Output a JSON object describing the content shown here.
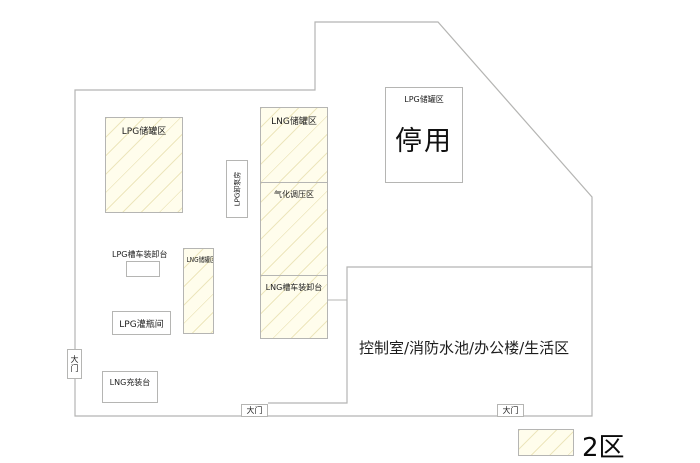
{
  "title": "LPG/LNG 站区平面图",
  "areas": {
    "lpg_storage_left": {
      "label": "LPG储罐区"
    },
    "lpg_pump_room": {
      "label": "LPG卸泵房"
    },
    "lng_storage": {
      "label": "LNG储罐区"
    },
    "gasification": {
      "label": "气化调压区"
    },
    "lng_truck_platform": {
      "label": "LNG槽车装卸台"
    },
    "lpg_storage_disabled": {
      "label": "LPG储罐区",
      "status": "停用"
    },
    "lpg_truck_platform": {
      "label": "LPG槽车装卸台"
    },
    "lng_tank_small": {
      "label": "LNG储罐区"
    },
    "lpg_bottle_room": {
      "label": "LPG灌瓶间"
    },
    "lng_filling_platform": {
      "label": "LNG充装台"
    },
    "control_area": {
      "label": "控制室/消防水池/办公楼/生活区"
    }
  },
  "gates": {
    "left": {
      "label": "大门"
    },
    "bottom_left": {
      "label": "大门"
    },
    "bottom_right": {
      "label": "大门"
    }
  },
  "legend": {
    "zone_label": "2区",
    "swatch_fill": "#fffdec",
    "hatch_color": "#ded498"
  },
  "colors": {
    "line": "#b5b5b3",
    "text": "#222222",
    "background": "#ffffff"
  }
}
